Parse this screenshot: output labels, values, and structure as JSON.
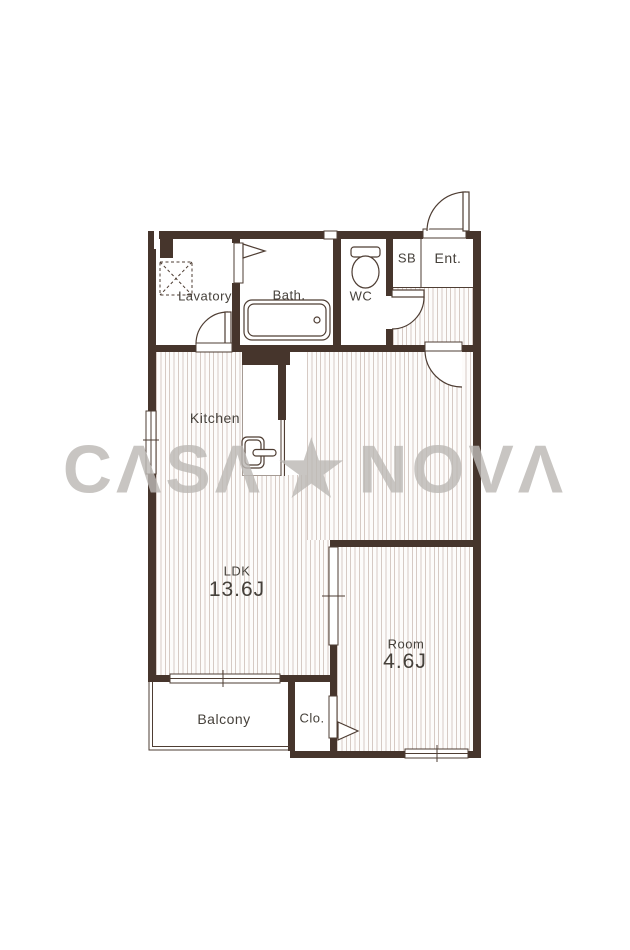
{
  "watermark": {
    "left": "CΛSΛ",
    "star": "★",
    "right": "NOVΛ"
  },
  "rooms": {
    "lavatory": {
      "label": "Lavatory"
    },
    "bath": {
      "label": "Bath."
    },
    "wc": {
      "label": "WC"
    },
    "shoe_box": {
      "label": "SB"
    },
    "entrance": {
      "label": "Ent."
    },
    "kitchen": {
      "label": "Kitchen"
    },
    "ldk": {
      "label": "LDK",
      "area": "13.6J"
    },
    "room": {
      "label": "Room",
      "area": "4.6J"
    },
    "balcony": {
      "label": "Balcony"
    },
    "closet": {
      "label": "Clo."
    }
  },
  "fixtures": {
    "washing_machine_pan": "washing-machine-pan",
    "bathtub": "bathtub",
    "toilet": "toilet",
    "kitchen_sink": "kitchen-sink"
  },
  "colors": {
    "wall": "#46352c",
    "line": "#4e3d33",
    "floor_stripe": "#d6cac4",
    "label_text": "#46413b",
    "watermark": "#bcb8b5"
  }
}
